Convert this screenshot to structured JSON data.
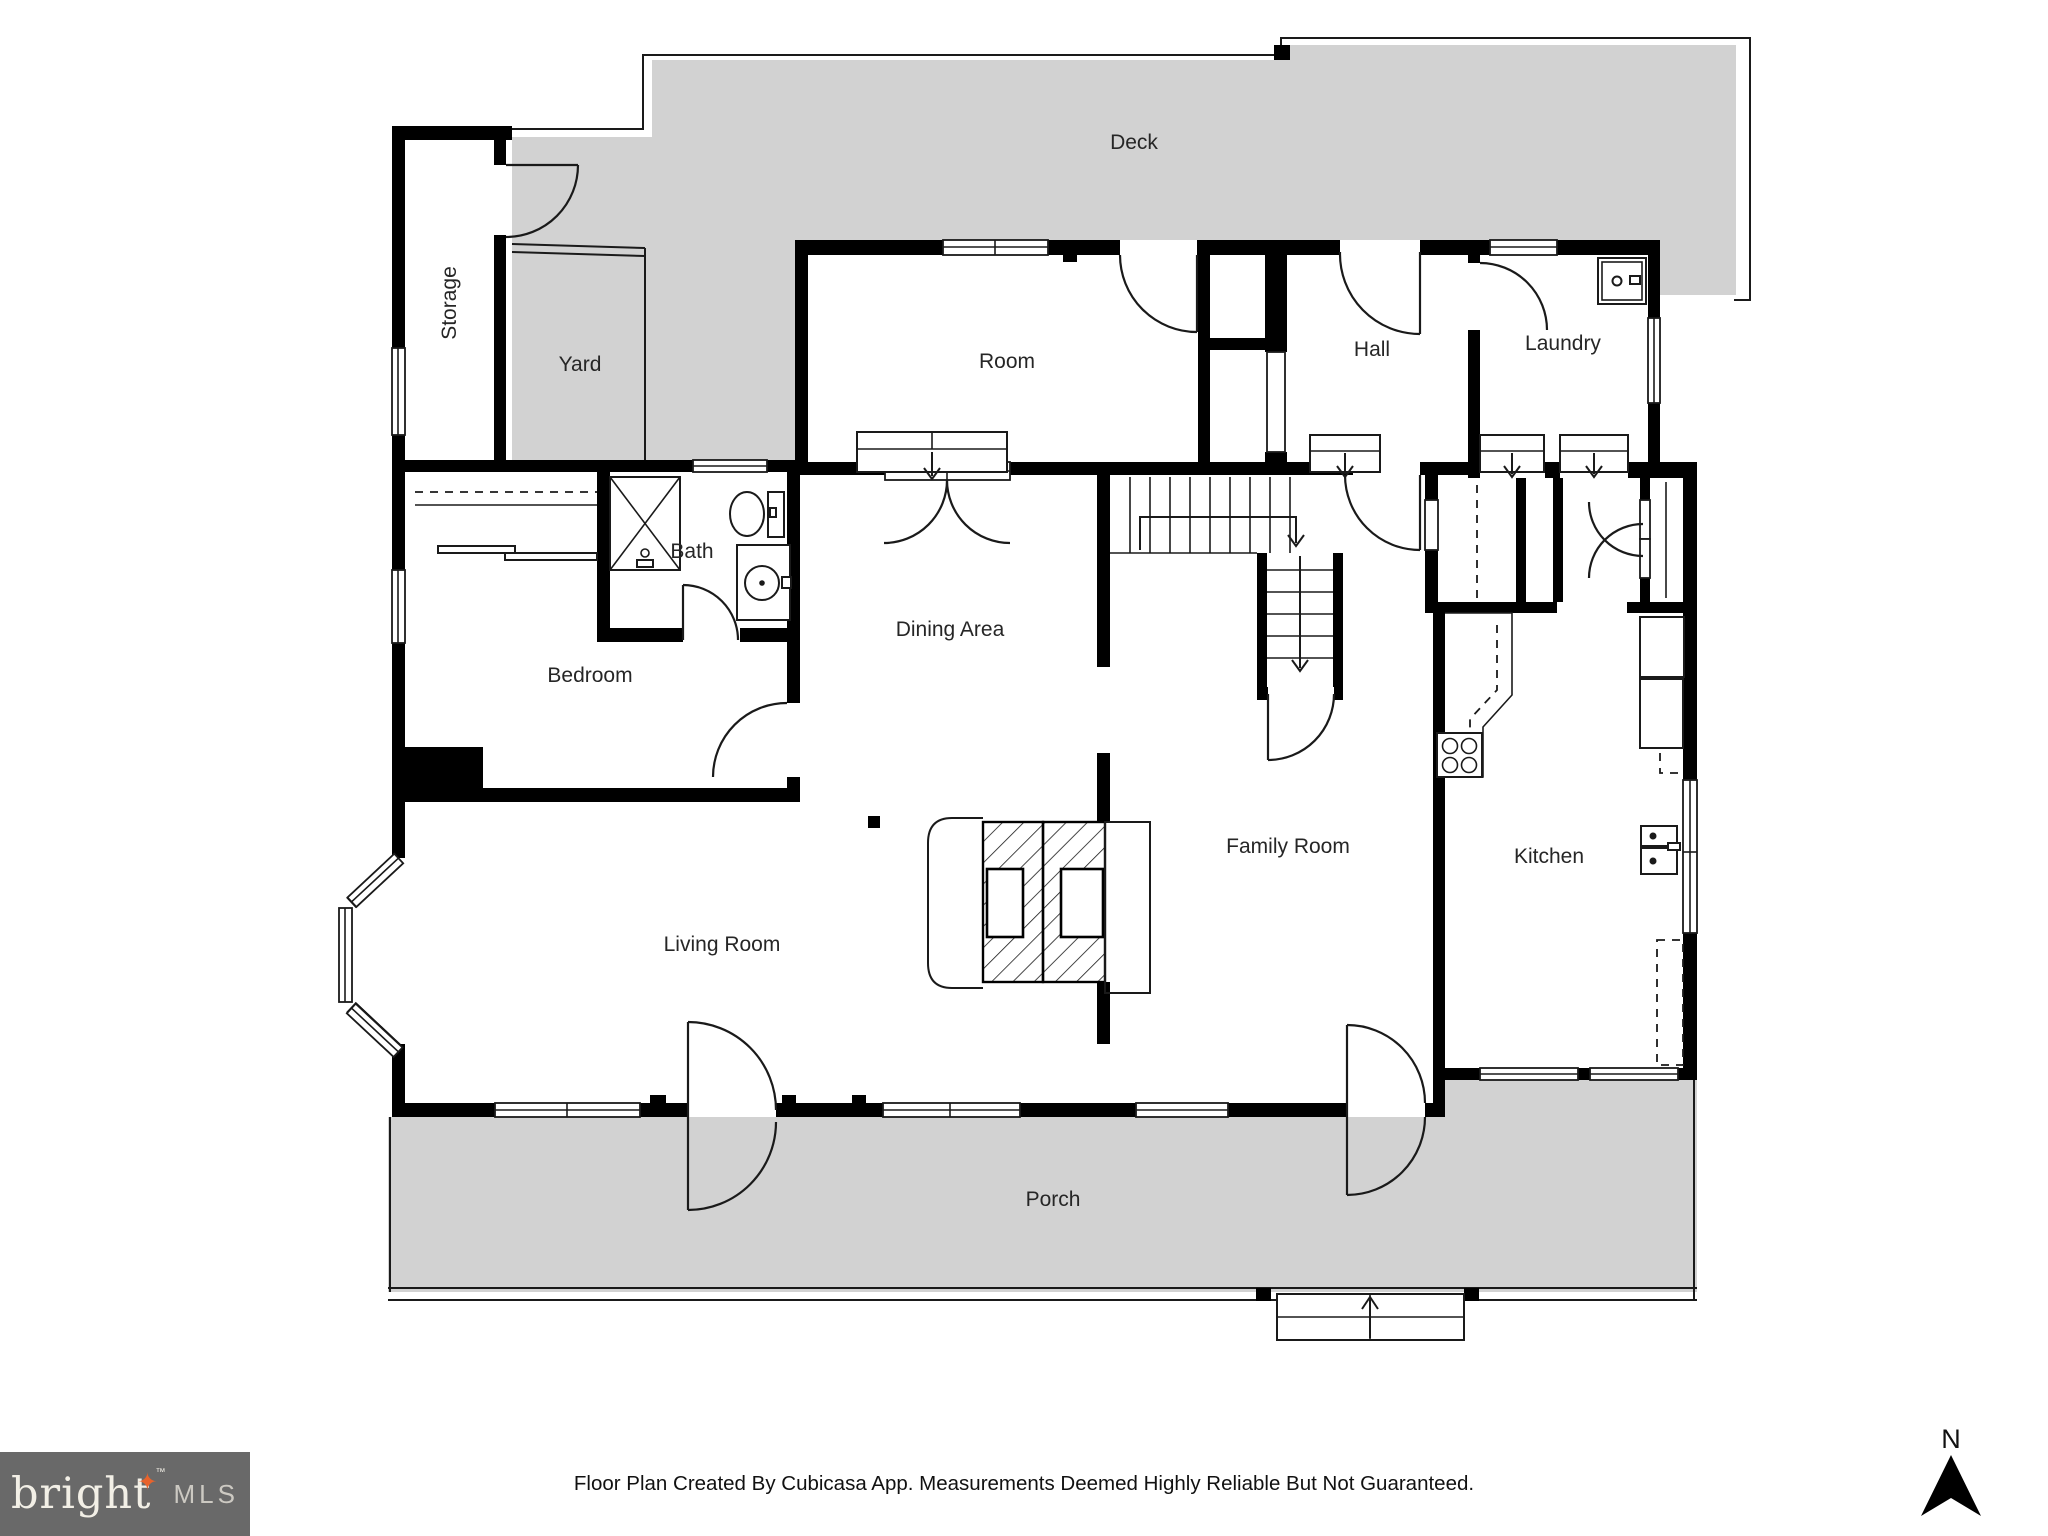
{
  "rooms": [
    {
      "id": "deck",
      "label": "Deck"
    },
    {
      "id": "storage",
      "label": "Storage"
    },
    {
      "id": "yard",
      "label": "Yard"
    },
    {
      "id": "room",
      "label": "Room"
    },
    {
      "id": "hall",
      "label": "Hall"
    },
    {
      "id": "laundry",
      "label": "Laundry"
    },
    {
      "id": "bath",
      "label": "Bath"
    },
    {
      "id": "dining-area",
      "label": "Dining Area"
    },
    {
      "id": "bedroom",
      "label": "Bedroom"
    },
    {
      "id": "family-room",
      "label": "Family Room"
    },
    {
      "id": "kitchen",
      "label": "Kitchen"
    },
    {
      "id": "living-room",
      "label": "Living Room"
    },
    {
      "id": "porch",
      "label": "Porch"
    }
  ],
  "footer": {
    "disclaimer": "Floor Plan Created By Cubicasa App. Measurements Deemed Highly Reliable But Not Guaranteed."
  },
  "logo": {
    "brand": "bright",
    "star": "✦",
    "tm": "™",
    "suffix": "MLS"
  },
  "compass": {
    "north_label": "N"
  },
  "colors": {
    "outdoor_fill": "#d2d2d2",
    "wall": "#000000",
    "logo_bg": "#696969",
    "logo_star": "#e8632c"
  }
}
